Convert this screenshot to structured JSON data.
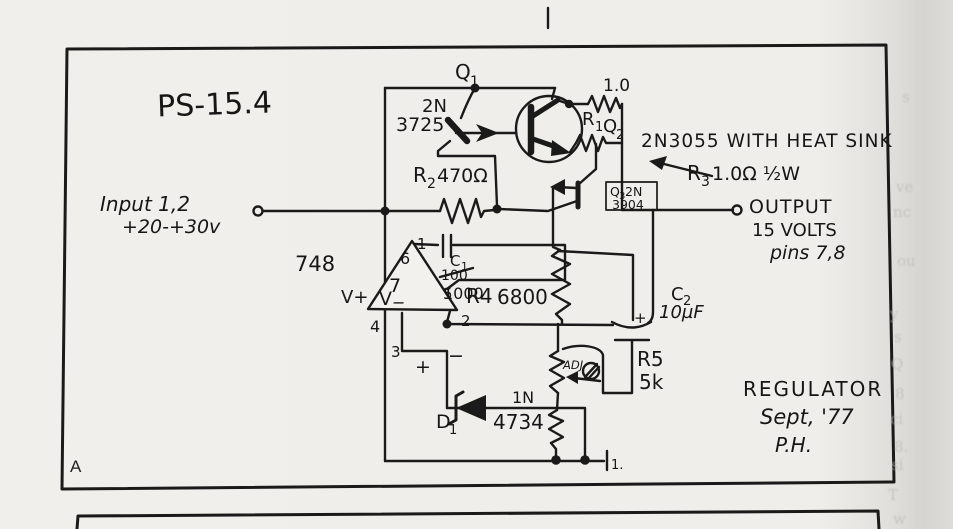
{
  "page": {
    "panel_label": "A",
    "ground_mark": "1.",
    "margin_fragments": [
      "s",
      "ve",
      "nc",
      "ou",
      "y",
      "s",
      "Q",
      "8",
      "ci",
      "8.",
      "si",
      "T",
      "d",
      "w"
    ]
  },
  "title": "PS-15.4",
  "io": {
    "input_line1": "Input 1,2",
    "input_line2": "+20-+30v",
    "output_line1": "OUTPUT",
    "output_line2": "15 VOLTS",
    "output_line3": "pins 7,8"
  },
  "annotations": {
    "q2_note": "2N3055 WITH HEAT SINK",
    "r3_ref": "R",
    "r3_sub": "3",
    "r3_value": "1.0Ω ½W",
    "footer_line1": "REGULATOR",
    "footer_line2": "Sept, '77",
    "footer_line3": "P.H."
  },
  "components": {
    "q1": {
      "ref": "Q",
      "sub": "1",
      "part_line1": "2N",
      "part_line2": "3725"
    },
    "r_top": {
      "value": "1.0"
    },
    "r1": {
      "ref": "R",
      "sub": "1"
    },
    "q2": {
      "ref": "Q",
      "sub": "2"
    },
    "q3": {
      "ref": "Q",
      "sub": "3",
      "part1": "2N",
      "part2": "3904"
    },
    "r2": {
      "ref": "R",
      "sub": "2",
      "value": "470Ω"
    },
    "opamp": {
      "part": "748",
      "vplus": "V+",
      "vminus": "V",
      "vminus_sub": "−",
      "pin1": "1",
      "pin2": "2",
      "pin3": "3",
      "pin4": "4",
      "pin5": "5",
      "pin6": "6",
      "pin7": "7",
      "plus": "+",
      "minus": "−"
    },
    "c1": {
      "ref": "C",
      "sub": "1",
      "old_value": "100",
      "value": "1000"
    },
    "r4": {
      "label": "R4",
      "value": "6800"
    },
    "c2": {
      "ref": "C",
      "sub": "2",
      "value": "10µF",
      "polarity": "+"
    },
    "r5": {
      "label": "R5",
      "value": "5k"
    },
    "adj": {
      "label": "ADJ"
    },
    "d1": {
      "ref": "D",
      "sub": "1",
      "part1": "1N",
      "part2": "4734"
    }
  },
  "colors": {
    "ink": "#1a1a1a",
    "paper": "#efeeea",
    "paper_inner": "#f2f1ed"
  }
}
